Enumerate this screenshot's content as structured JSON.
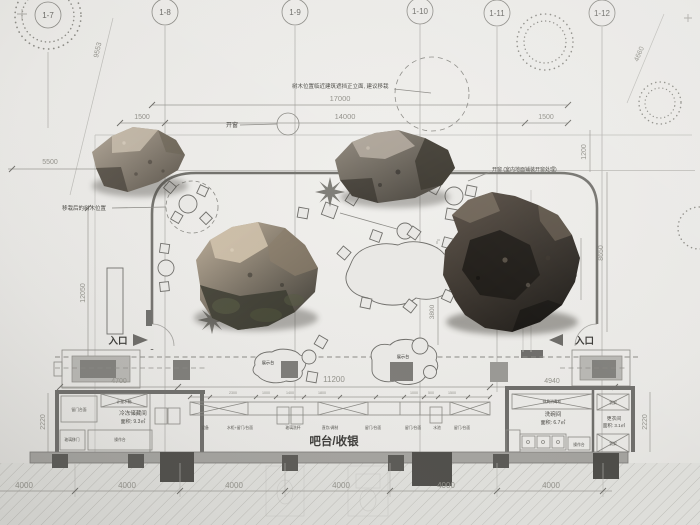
{
  "grid": {
    "bubbles": [
      "1-7",
      "1-8",
      "1-9",
      "1-10",
      "1-11",
      "1-12"
    ]
  },
  "dims": {
    "top_total": "17000",
    "seg_left": "1500",
    "seg_mid": "14000",
    "seg_right": "1500",
    "diag_left": "9553",
    "diag_right": "4660",
    "left_offset": "5500",
    "left_height": "12050",
    "left_wall": "2220",
    "right_top": "1200",
    "right_height": "8650",
    "right_inner": "3450",
    "right_wall": "2220",
    "mid_inner": "3800",
    "front_left": "4700",
    "front_mid": "11200",
    "front_right": "4940",
    "bottom": [
      "4000",
      "4000",
      "4000",
      "4000",
      "4000",
      "4000"
    ],
    "counter_segs": [
      "1000",
      "2300",
      "1000",
      "1400",
      "1800",
      "1000",
      "500",
      "1500"
    ]
  },
  "annotations": {
    "tree_note": "树木位置临近建筑遮挡正立面, 建议移栽",
    "transplant_note": "移栽后的树木位置",
    "window_note": "开窗",
    "window_detail_note": "开窗 (室内地面铺装开窗处理)",
    "private_room_1": "包",
    "private_room_2": "间",
    "entrance_left": "入口",
    "entrance_right": "入口",
    "display_stand_left": "展示台",
    "display_stand_right": "展示台"
  },
  "rooms": {
    "bar_label": "吧台/收银",
    "freezer_name": "冷冻储藏间",
    "freezer_area": "面积: 9.3㎡",
    "dishwash_name": "洗碗间",
    "dishwash_area": "面积: 6.7㎡",
    "changing_name": "更衣间",
    "changing_area": "面积: 3.1㎡"
  },
  "counter_labels": [
    "设备",
    "水柜+留门/台面",
    "玻璃洗杯",
    "直饮/调制",
    "留门/台面",
    "留门/台面",
    "水池",
    "留门/台面"
  ],
  "left_labels": [
    "留门台面",
    "计量水箱",
    "玻璃移门",
    "操作台"
  ],
  "right_labels": [
    "餐具消毒柜",
    "货架",
    "货架",
    "操作台"
  ]
}
